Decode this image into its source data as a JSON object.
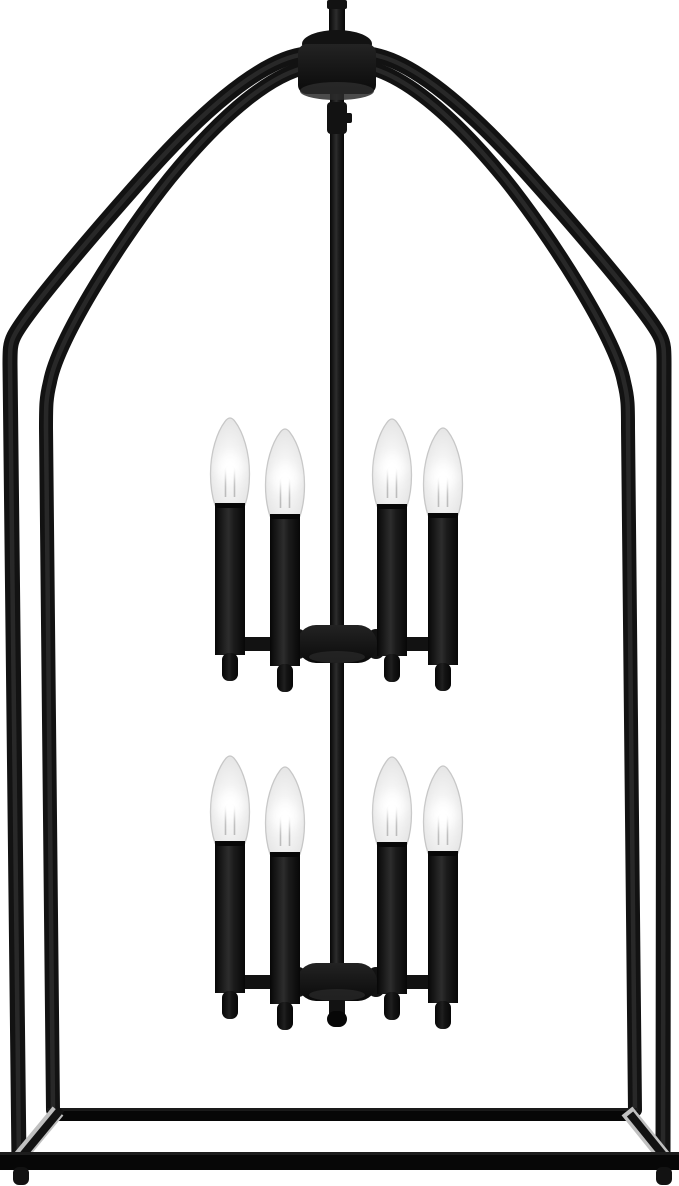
{
  "product": {
    "name": "Two-tier 8-light caged lantern candle chandelier, matte black, flame-tip bulbs",
    "light_count": 8,
    "tier_count": 2,
    "finish": "matte black"
  },
  "colors": {
    "background": "#ffffff",
    "metal": "#121212",
    "metal_deep": "#070707",
    "metal_sheen": "#2d2d2d",
    "hub_top": "#232323",
    "hub_bottom": "#0a0a0a",
    "hub_face": "#2b2b2b",
    "steel_highlight": "#c0c0c0",
    "bulb_edge": "#c7c7c7",
    "bulb_glass_light": "#ffffff",
    "bulb_glass_mid": "#f1f1f1",
    "bulb_glass_dark": "#d8d8d8",
    "filament": "#a0a0a0",
    "glow": "#ffffff"
  },
  "geometry": {
    "canvas": {
      "width": 679,
      "height": 1186
    },
    "rod_x": 337,
    "tiers": [
      {
        "dy": 0,
        "hub_y": 625,
        "arm_y": 637
      },
      {
        "dy": 338,
        "hub_y": 963,
        "arm_y": 975
      }
    ],
    "candles": [
      {
        "x": 230,
        "y": 417
      },
      {
        "x": 285,
        "y": 428
      },
      {
        "x": 392,
        "y": 418
      },
      {
        "x": 443,
        "y": 427
      }
    ],
    "arm_spans": [
      {
        "x": 222,
        "width": 82
      },
      {
        "x": 371,
        "width": 82
      }
    ]
  }
}
